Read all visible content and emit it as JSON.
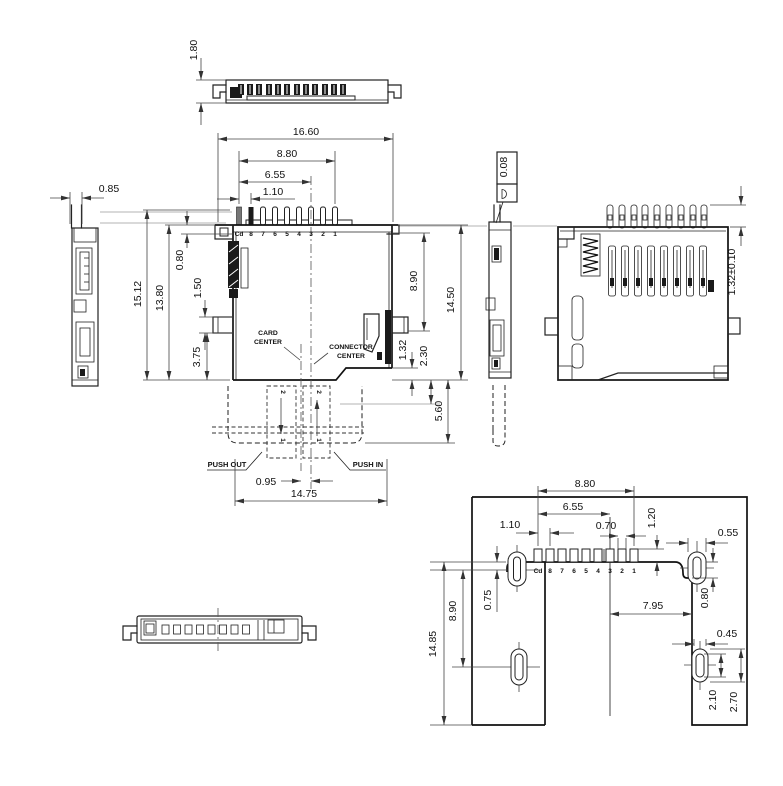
{
  "drawing": {
    "background": "#ffffff",
    "line_color": "#1a1a1a",
    "dim_color": "#444444",
    "top_view": {
      "height": "1.80"
    },
    "left_view": {
      "width": "0.85"
    },
    "main_view": {
      "total_width": "16.60",
      "pin_span": "8.80",
      "pin_to_center": "6.55",
      "pin_pitch": "1.10",
      "total_height": "15.12",
      "body_height": "13.80",
      "top_offset": "0.80",
      "tab_height": "1.50",
      "tab_to_bottom": "3.75",
      "depth_right": "8.90",
      "height_right": "14.50",
      "step_height": "1.32",
      "card_bottom_offset": "2.30",
      "card_protrusion": "5.60",
      "center_offset": "0.95",
      "mount_width": "14.75",
      "pin_labels": [
        "Cd",
        "8",
        "7",
        "6",
        "5",
        "4",
        "3",
        "2",
        "1"
      ],
      "card_center_lines": [
        "CARD",
        "CENTER"
      ],
      "connector_center_lines": [
        "CONNECTOR",
        "CENTER"
      ],
      "push_out": "PUSH OUT",
      "push_in": "PUSH IN",
      "card_marks": [
        "2",
        "1"
      ]
    },
    "gdt": {
      "flatness": "0.08"
    },
    "back_view": {
      "pin_height": "1.32±0.10"
    },
    "footprint_view": {
      "pad_span": "8.80",
      "pad_to_center": "6.55",
      "pad_pitch": "1.10",
      "pad_width": "0.70",
      "pad_height": "1.20",
      "hole_top_width": "0.55",
      "hole_offset_left": "0.75",
      "hole_span": "8.90",
      "total_height": "14.85",
      "center_to_edge": "7.95",
      "edge_offset": "0.80",
      "hole_bottom_width": "0.45",
      "slot_inner": "2.10",
      "slot_outer": "2.70",
      "pad_labels": [
        "Cd",
        "8",
        "7",
        "6",
        "5",
        "4",
        "3",
        "2",
        "1"
      ]
    }
  }
}
